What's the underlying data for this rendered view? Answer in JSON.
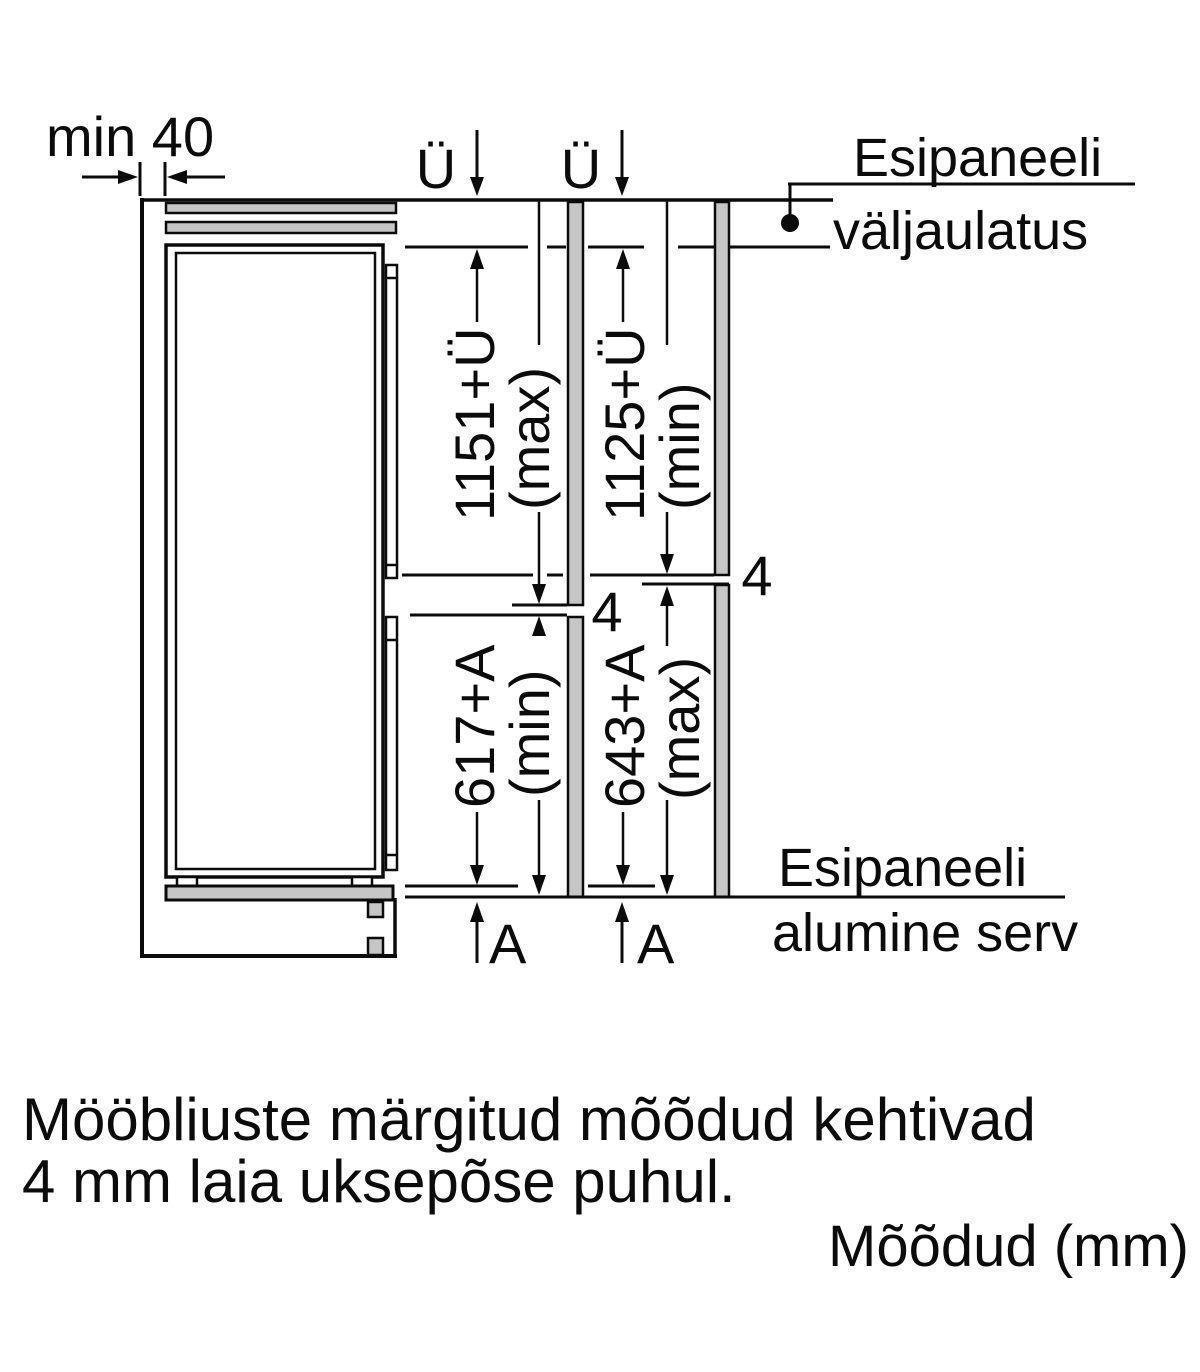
{
  "labels": {
    "min40": "min 40",
    "overhang_symbol": "Ü",
    "gap": "4",
    "bottom_overhang_symbol": "A",
    "top_note_1": "Esipaneeli",
    "top_note_2": "väljaulatus",
    "bottom_note_1": "Esipaneeli",
    "bottom_note_2": "alumine serv"
  },
  "dimensions": {
    "upper_left": "1151+Ü",
    "upper_left_qual": "(max)",
    "upper_right": "1125+Ü",
    "upper_right_qual": "(min)",
    "lower_left": "617+A",
    "lower_left_qual": "(min)",
    "lower_right": "643+A",
    "lower_right_qual": "(max)"
  },
  "footer": {
    "note_line1": "Mööbliuste märgitud mõõdud kehtivad",
    "note_line2": "4 mm laia uksepõse puhul.",
    "units": "Mõõdud (mm)"
  },
  "colors": {
    "line": "#0b0b0b",
    "panel": "#c6c6c6",
    "background": "#ffffff"
  }
}
